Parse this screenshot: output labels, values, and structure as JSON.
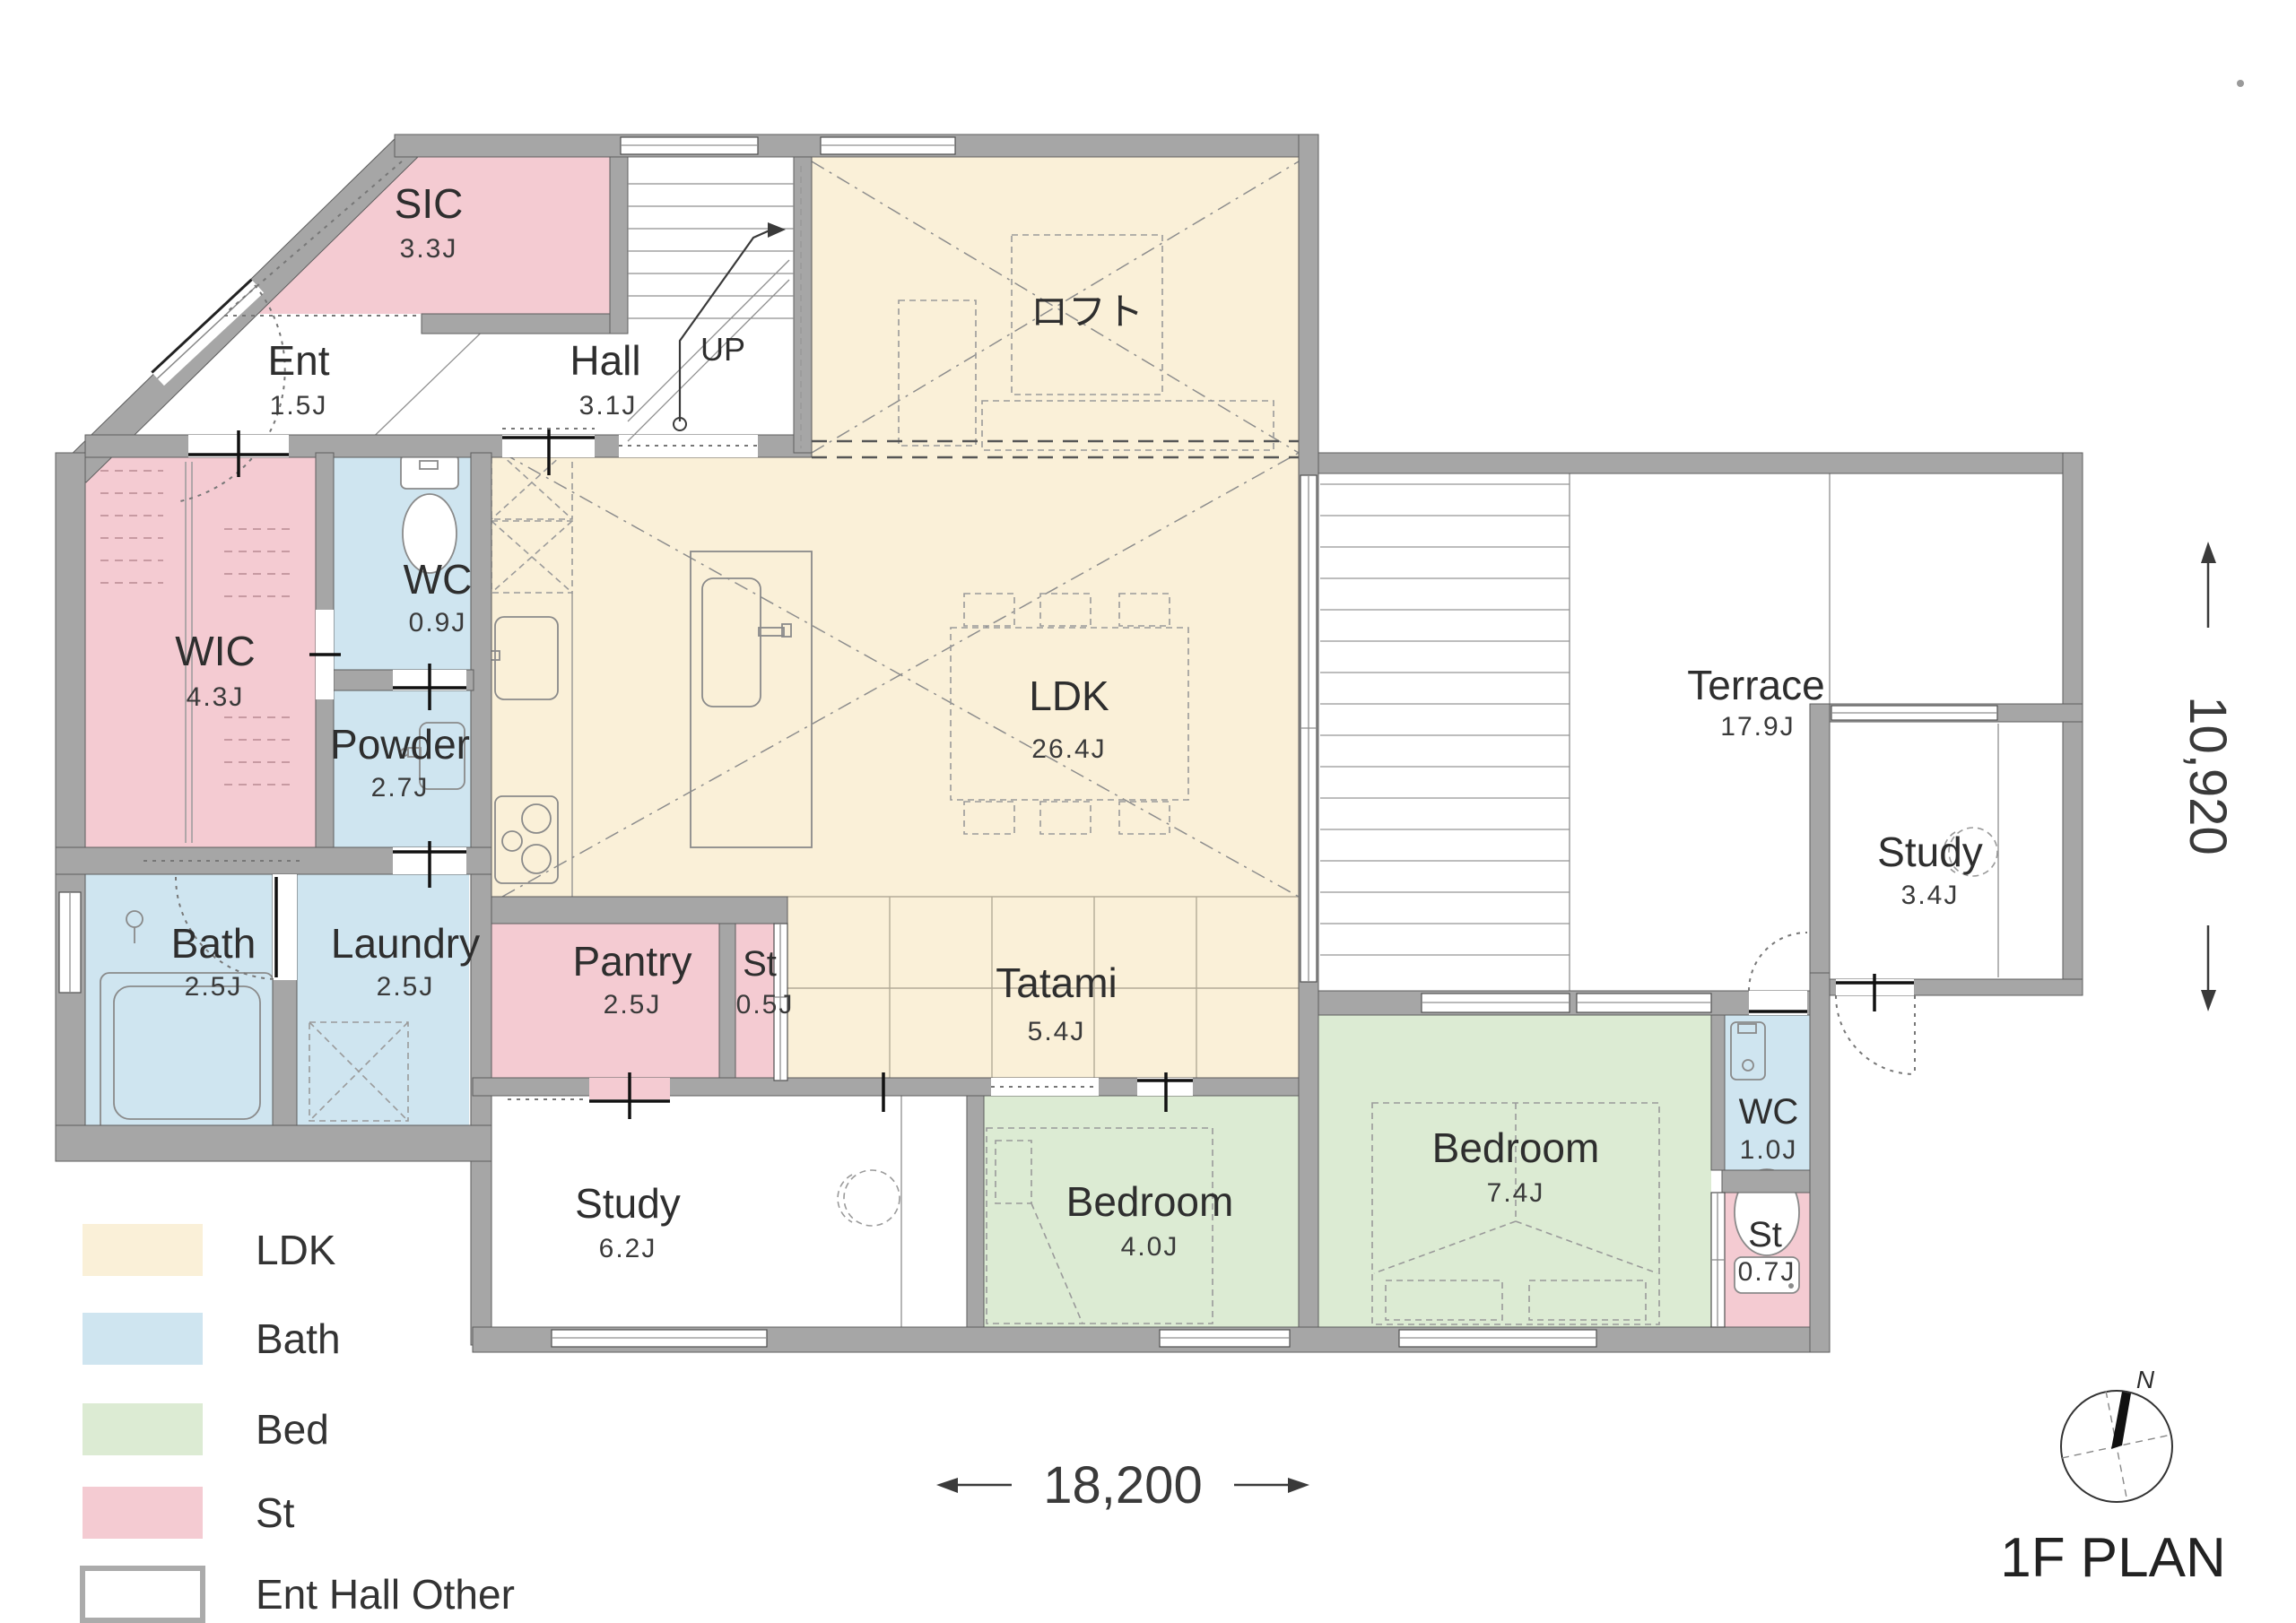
{
  "plan_title": "1F PLAN",
  "compass": {
    "north_label": "N"
  },
  "dimensions": {
    "width_label": "18,200",
    "height_label": "10,920"
  },
  "stairs": {
    "up_label": "UP"
  },
  "legend": {
    "items": [
      {
        "label": "LDK",
        "color": "#faf0d8"
      },
      {
        "label": "Bath",
        "color": "#cfe5f0"
      },
      {
        "label": "Bed",
        "color": "#dcebd3"
      },
      {
        "label": "St",
        "color": "#f4cbd2"
      },
      {
        "label": "Ent Hall Other",
        "color": "#ffffff"
      }
    ]
  },
  "colors": {
    "ldk": "#faf0d8",
    "bath": "#cfe5f0",
    "bed": "#dcebd3",
    "storage": "#f4cbd2",
    "other": "#ffffff",
    "wall": "#a6a6a6"
  },
  "rooms": [
    {
      "name": "SIC",
      "area": "3.3J"
    },
    {
      "name": "Ent",
      "area": "1.5J"
    },
    {
      "name": "Hall",
      "area": "3.1J"
    },
    {
      "name": "ロフト"
    },
    {
      "name": "WIC",
      "area": "4.3J"
    },
    {
      "name": "WC",
      "area": "0.9J"
    },
    {
      "name": "Powder",
      "area": "2.7J"
    },
    {
      "name": "LDK",
      "area": "26.4J"
    },
    {
      "name": "Tatami",
      "area": "5.4J"
    },
    {
      "name": "Pantry",
      "area": "2.5J"
    },
    {
      "name": "St",
      "area": "0.5J"
    },
    {
      "name": "Bath",
      "area": "2.5J"
    },
    {
      "name": "Laundry",
      "area": "2.5J"
    },
    {
      "name": "Study",
      "area": "6.2J"
    },
    {
      "name": "Bedroom",
      "area": "4.0J"
    },
    {
      "name": "Bedroom",
      "area": "7.4J"
    },
    {
      "name": "WC",
      "area": "1.0J"
    },
    {
      "name": "St",
      "area": "0.7J"
    },
    {
      "name": "Terrace",
      "area": "17.9J"
    },
    {
      "name": "Study",
      "area": "3.4J"
    }
  ]
}
